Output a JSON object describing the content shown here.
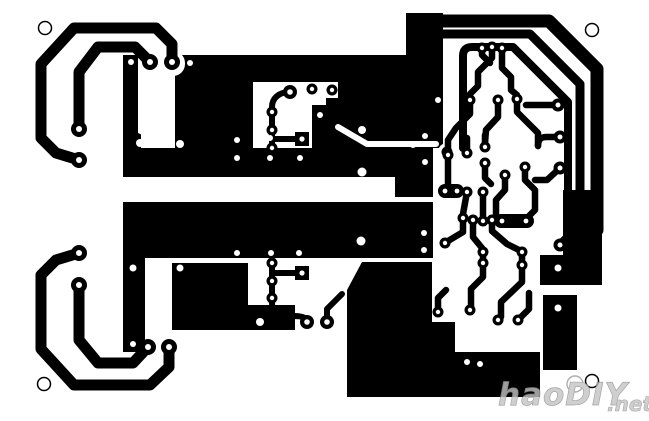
{
  "pcb": {
    "canvas": {
      "width": 649,
      "height": 421,
      "background": "#ffffff",
      "copper_color": "#000000"
    },
    "watermark": {
      "text": "haoDIY",
      "suffix": ".net",
      "color": "#c4c4c4",
      "outline": "#8f8f8f"
    },
    "mount_holes": [
      {
        "x": 45,
        "y": 28,
        "r": 6.5
      },
      {
        "x": 592,
        "y": 30,
        "r": 6.5
      },
      {
        "x": 44,
        "y": 384,
        "r": 6.5
      },
      {
        "x": 592,
        "y": 381,
        "r": 6.5
      }
    ],
    "blocks": [
      {
        "type": "rect",
        "x": 123,
        "y": 55,
        "w": 15,
        "h": 81
      },
      {
        "type": "rect",
        "x": 123,
        "y": 136,
        "w": 15,
        "h": 41
      },
      {
        "type": "poly",
        "pts": "138,133 175,150 138,150"
      },
      {
        "type": "rect",
        "x": 123,
        "y": 148,
        "w": 52,
        "h": 29
      },
      {
        "type": "rect",
        "x": 175,
        "y": 55,
        "w": 165,
        "h": 93
      },
      {
        "type": "rect",
        "x": 406,
        "y": 13,
        "w": 37,
        "h": 42
      },
      {
        "type": "rect",
        "x": 340,
        "y": 55,
        "w": 103,
        "h": 47
      },
      {
        "type": "rect",
        "x": 338,
        "y": 102,
        "w": 105,
        "h": 46
      },
      {
        "type": "rect",
        "x": 123,
        "y": 148,
        "w": 310,
        "h": 29
      },
      {
        "type": "rect",
        "x": 395,
        "y": 148,
        "w": 38,
        "h": 49
      },
      {
        "type": "rect",
        "x": 123,
        "y": 202,
        "w": 310,
        "h": 56
      },
      {
        "type": "rect",
        "x": 123,
        "y": 202,
        "w": 22,
        "h": 150
      },
      {
        "type": "rect",
        "x": 172,
        "y": 263,
        "w": 76,
        "h": 67
      },
      {
        "type": "rect",
        "x": 248,
        "y": 305,
        "w": 47,
        "h": 25
      },
      {
        "type": "poly",
        "pts": "362,262 432,262 432,397 347,397 347,290"
      },
      {
        "type": "rect",
        "x": 432,
        "y": 352,
        "w": 108,
        "h": 45
      },
      {
        "type": "rect",
        "x": 432,
        "y": 322,
        "w": 23,
        "h": 30
      },
      {
        "type": "poly",
        "pts": "563,190 602,190 602,285 540,285 540,255 563,255"
      },
      {
        "type": "rect",
        "x": 543,
        "y": 295,
        "w": 34,
        "h": 75
      }
    ],
    "white_cuts": [
      {
        "type": "rrect",
        "x": 139,
        "y": 51,
        "w": 46,
        "h": 25,
        "r": 12
      },
      {
        "type": "rect",
        "x": 141,
        "y": 63,
        "w": 30,
        "h": 85
      },
      {
        "type": "poly",
        "pts": "253,82 338,82 338,98 326,98 326,105 312,105 312,148 253,148"
      },
      {
        "type": "circle",
        "x": 447,
        "y": 152,
        "r": 9
      }
    ],
    "white_channels": [
      {
        "d": "M338,127 L367,144 L436,144",
        "w": 6
      }
    ],
    "traces": [
      {
        "d": "M79,160 L56,153 L41,138 L41,64 L74,28 L156,28 L172,44 L172,62",
        "w": 11
      },
      {
        "d": "M79,129 L79,72 L98,47 L135,47 L150,62",
        "w": 11
      },
      {
        "d": "M79,253 L56,260 L41,275 L41,349 L74,385 L150,385 L169,367 L169,347",
        "w": 11
      },
      {
        "d": "M79,285 L79,340 L98,363 L133,363 L148,347",
        "w": 11
      },
      {
        "d": "M441,21 L549,21 L597,69 L597,230",
        "w": 13
      },
      {
        "d": "M441,34 L530,34 L580,84 L580,225 L561,244",
        "w": 9
      },
      {
        "d": "M463,148 L463,56 Q463,47 472,47 L513,47 L568,102 L568,210",
        "w": 8
      },
      {
        "d": "M290,92 C278,92 272,99 272,107 L272,148",
        "w": 6
      },
      {
        "d": "M272,139 L298,139",
        "w": 6
      },
      {
        "d": "M272,263 L272,298",
        "w": 6
      },
      {
        "d": "M272,273 L298,273",
        "w": 6
      },
      {
        "d": "M272,298 L272,303 Q272,316 286,316 L294,316 Q307,316 307,322",
        "w": 6
      },
      {
        "d": "M327,322 L327,309 L342,294",
        "w": 6
      },
      {
        "d": "M482,48 L482,55 L490,63",
        "w": 6.5
      },
      {
        "d": "M492,47 L492,58 L478,72 L478,86 L470,94",
        "w": 6.5
      },
      {
        "d": "M502,48 L502,68 L511,77 L511,90 L517,95",
        "w": 6.5
      },
      {
        "d": "M470,100 L470,114 L456,128 L448,140 L448,152",
        "w": 6.5
      },
      {
        "d": "M498,100 L498,117 L486,130 L485,143",
        "w": 6.5
      },
      {
        "d": "M517,99 L517,112 L531,126 L538,133 L538,146",
        "w": 6.5
      },
      {
        "d": "M560,137 L546,137 Q538,137 538,146",
        "w": 6.5
      },
      {
        "d": "M558,105 L526,105",
        "w": 6.5
      },
      {
        "d": "M560,168 L547,180 L535,180",
        "w": 6.5
      },
      {
        "d": "M467,153 L467,138",
        "w": 6.5
      },
      {
        "d": "M485,147 L485,135",
        "w": 6.5
      },
      {
        "d": "M448,157 L448,186",
        "w": 6.5
      },
      {
        "d": "M485,163 L485,178 L491,184",
        "w": 6.5
      },
      {
        "d": "M467,192 L463,214",
        "w": 6.5
      },
      {
        "d": "M483,192 L483,216",
        "w": 6.5
      },
      {
        "d": "M505,175 L505,190 L496,200 L496,214",
        "w": 6.5
      },
      {
        "d": "M525,167 L525,180 L535,190 L535,210 L527,218",
        "w": 6.5
      },
      {
        "d": "M463,218 L463,232 L448,241",
        "w": 6.5
      },
      {
        "d": "M473,220 L473,237 L482,248",
        "w": 6.5
      },
      {
        "d": "M492,220 L492,231 L507,244 L519,250",
        "w": 6.5
      },
      {
        "d": "M483,252 L483,263",
        "w": 6.5
      },
      {
        "d": "M522,252 L522,265",
        "w": 6.5
      },
      {
        "d": "M483,263 L483,277 L471,289 L471,308",
        "w": 6.5
      },
      {
        "d": "M522,265 L522,282 L501,302 L501,317",
        "w": 6.5
      },
      {
        "d": "M438,312 L438,298 L446,290",
        "w": 6.5
      },
      {
        "d": "M518,320 L529,309 L529,293",
        "w": 6.5
      },
      {
        "d": "M560,245 L572,233",
        "w": 6.5
      }
    ],
    "slots": [
      {
        "x": 438,
        "y": 184,
        "w": 26,
        "h": 14,
        "r": 7,
        "holes": [
          [
            445,
            191
          ],
          [
            457,
            191
          ]
        ]
      },
      {
        "x": 494,
        "y": 214,
        "w": 40,
        "h": 14,
        "r": 7,
        "holes": [
          [
            502,
            221
          ],
          [
            526,
            221
          ]
        ]
      }
    ],
    "square_pads": [
      {
        "x": 295,
        "y": 132,
        "w": 14,
        "h": 14,
        "hx": 302,
        "hy": 139
      },
      {
        "x": 295,
        "y": 266,
        "w": 14,
        "h": 14,
        "hx": 302,
        "hy": 273
      }
    ],
    "pads": [
      [
        79,
        160,
        8,
        3
      ],
      [
        172,
        62,
        8,
        3
      ],
      [
        79,
        129,
        8,
        3
      ],
      [
        150,
        62,
        8,
        3
      ],
      [
        79,
        253,
        8,
        3
      ],
      [
        169,
        347,
        8,
        3
      ],
      [
        79,
        285,
        8,
        3
      ],
      [
        148,
        347,
        8,
        3
      ],
      [
        290,
        92,
        7,
        2.8
      ],
      [
        307,
        322,
        7,
        2.8
      ],
      [
        327,
        322,
        7,
        2.8
      ],
      [
        558,
        105,
        6.5,
        2.5
      ],
      [
        560,
        137,
        6.5,
        2.5
      ],
      [
        560,
        168,
        6.5,
        2.5
      ],
      [
        560,
        245,
        6.5,
        2.5
      ],
      [
        272,
        112,
        5.5,
        2.2
      ],
      [
        272,
        130,
        5.5,
        2.2
      ],
      [
        272,
        148,
        5.5,
        2.2
      ],
      [
        312,
        89,
        5.5,
        2.2
      ],
      [
        332,
        90,
        5.5,
        2.2
      ],
      [
        447,
        152,
        5.5,
        2.2
      ],
      [
        272,
        263,
        5.5,
        2.2
      ],
      [
        272,
        281,
        5.5,
        2.2
      ],
      [
        272,
        298,
        5.5,
        2.2
      ],
      [
        482,
        48,
        5.5,
        2.2
      ],
      [
        492,
        47,
        5.5,
        2.2
      ],
      [
        502,
        48,
        5.5,
        2.2
      ],
      [
        470,
        100,
        5.5,
        2.2
      ],
      [
        498,
        100,
        5.5,
        2.2
      ],
      [
        517,
        99,
        5.5,
        2.2
      ],
      [
        448,
        155,
        5.5,
        2.2
      ],
      [
        467,
        153,
        5.5,
        2.2
      ],
      [
        485,
        147,
        5.5,
        2.2
      ],
      [
        485,
        163,
        5.5,
        2.2
      ],
      [
        505,
        175,
        5.5,
        2.2
      ],
      [
        525,
        167,
        5.5,
        2.2
      ],
      [
        467,
        192,
        5.5,
        2.2
      ],
      [
        483,
        192,
        5.5,
        2.2
      ],
      [
        463,
        218,
        5.5,
        2.2
      ],
      [
        473,
        220,
        5.5,
        2.2
      ],
      [
        483,
        221,
        5.5,
        2.2
      ],
      [
        492,
        220,
        5.5,
        2.2
      ],
      [
        445,
        243,
        5.5,
        2.2
      ],
      [
        483,
        252,
        5.5,
        2.2
      ],
      [
        522,
        252,
        5.5,
        2.2
      ],
      [
        483,
        263,
        5.5,
        2.2
      ],
      [
        522,
        265,
        5.5,
        2.2
      ],
      [
        470,
        310,
        5.5,
        2.2
      ],
      [
        438,
        312,
        5.5,
        2.2
      ],
      [
        498,
        320,
        5.5,
        2.2
      ],
      [
        518,
        320,
        5.5,
        2.2
      ]
    ],
    "vias": [
      [
        131,
        62,
        3
      ],
      [
        190,
        63,
        3
      ],
      [
        140,
        143,
        4
      ],
      [
        180,
        144,
        4
      ],
      [
        237,
        140,
        3
      ],
      [
        270,
        138,
        3
      ],
      [
        320,
        115,
        3
      ],
      [
        362,
        130,
        4
      ],
      [
        362,
        172,
        4.5
      ],
      [
        237,
        158,
        3
      ],
      [
        270,
        158,
        3
      ],
      [
        300,
        158,
        3
      ],
      [
        413,
        145,
        3
      ],
      [
        425,
        136,
        3
      ],
      [
        425,
        162,
        3
      ],
      [
        438,
        100,
        3
      ],
      [
        237,
        253,
        3
      ],
      [
        271,
        253,
        3
      ],
      [
        299,
        253,
        3
      ],
      [
        361,
        241,
        4.5
      ],
      [
        424,
        233,
        3
      ],
      [
        424,
        250,
        3
      ],
      [
        133,
        268,
        3.5
      ],
      [
        180,
        268,
        3.5
      ],
      [
        133,
        344,
        3
      ],
      [
        260,
        322,
        4
      ],
      [
        558,
        268,
        3.5
      ],
      [
        558,
        308,
        3.5
      ],
      [
        467,
        362,
        3
      ],
      [
        480,
        364,
        3
      ]
    ]
  }
}
